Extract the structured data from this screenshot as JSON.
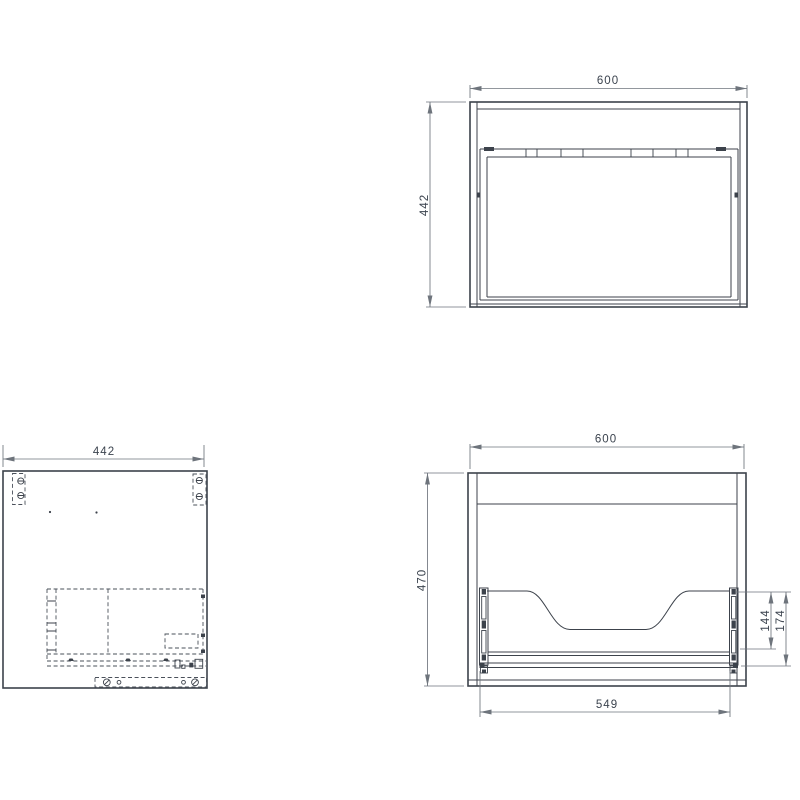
{
  "document": {
    "type": "technical-drawing",
    "background": "#ffffff"
  },
  "colors": {
    "object_line": "#3c424b",
    "hidden_line": "#4a505a",
    "dimension_line": "#6e747c",
    "dimension_text": "#3b434e"
  },
  "views": {
    "front": {
      "width": "600",
      "height": "442"
    },
    "side": {
      "width": "442"
    },
    "back": {
      "width": "600",
      "height": "470",
      "drawer_back_height": "144",
      "drawer_back_total": "174",
      "drawer_width": "549"
    }
  }
}
